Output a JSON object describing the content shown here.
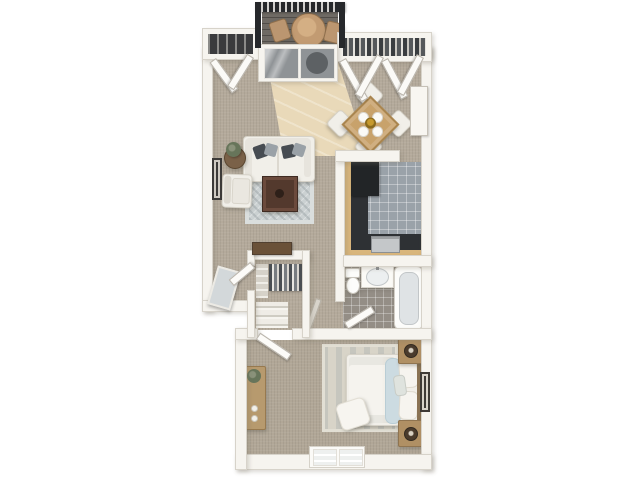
{
  "palette": {
    "background": "#ffffff",
    "wall": "#f6f4ef",
    "wall_edge": "#beb8ac",
    "carpet_living": "#b4aa9b",
    "carpet_bedroom": "#b1a797",
    "tile_entry": "#e9d9b9",
    "tile_kitchen": "#9aa2a9",
    "tile_bath": "#948e86",
    "counter_dark": "#2e3134",
    "counter_wood": "#d9b67c",
    "appliance_dark": "#222527",
    "stove_steel": "#c4c7c9",
    "railing_dark": "#26282b",
    "balcony_floor": "#6f6a64",
    "glass": "#8f9396",
    "glass_dark": "#5d6164",
    "furniture_white": "#f1efe9",
    "furniture_border": "#d6d2c8",
    "pillow_dark": "#474c52",
    "pillow_gray": "#9aa1a7",
    "rug_living": "#cbd1d2",
    "rug_bedroom": "#d8d4c8",
    "table_wood": "#c8a26b",
    "coffee_table": "#53392d",
    "console_wood": "#6a5138",
    "nightstand_wood": "#b09064",
    "dresser_wood": "#b79a6e",
    "headboard_wood": "#8a7354",
    "accent_blue": "#ccdbe1",
    "plant_green": "#67755a",
    "centerpiece_gold": "#c79a2e",
    "door_leaf": "#fcfbf8"
  },
  "scene": {
    "type": "3d-floor-plan-render",
    "rooms": [
      {
        "name": "balcony",
        "items": [
          "railing",
          "bistro-table",
          "bistro-chair",
          "bistro-chair"
        ]
      },
      {
        "name": "living-room",
        "items": [
          "sofa",
          "armchair",
          "coffee-table",
          "area-rug",
          "side-table-with-plant",
          "wall-art",
          "console-table",
          "entry-tile-path",
          "sliding-glass-door",
          "coat-closet-bifold"
        ]
      },
      {
        "name": "dining-area",
        "items": [
          "dining-table",
          "dining-chair",
          "dining-chair",
          "dining-chair",
          "dining-chair",
          "double-closet-bifold"
        ]
      },
      {
        "name": "kitchen",
        "items": [
          "l-shaped-counter",
          "refrigerator",
          "stove"
        ]
      },
      {
        "name": "bathroom",
        "items": [
          "toilet",
          "sink-vanity",
          "bathtub",
          "door"
        ]
      },
      {
        "name": "walk-in-closet",
        "items": [
          "hanging-clothes",
          "shelving",
          "shoe-rack",
          "door"
        ]
      },
      {
        "name": "hallway",
        "items": [
          "leaning-mirror"
        ]
      },
      {
        "name": "bedroom",
        "items": [
          "bed",
          "area-rug",
          "nightstand",
          "nightstand",
          "lamp",
          "lamp",
          "dresser-with-plant",
          "wall-art",
          "window",
          "door"
        ]
      }
    ]
  }
}
